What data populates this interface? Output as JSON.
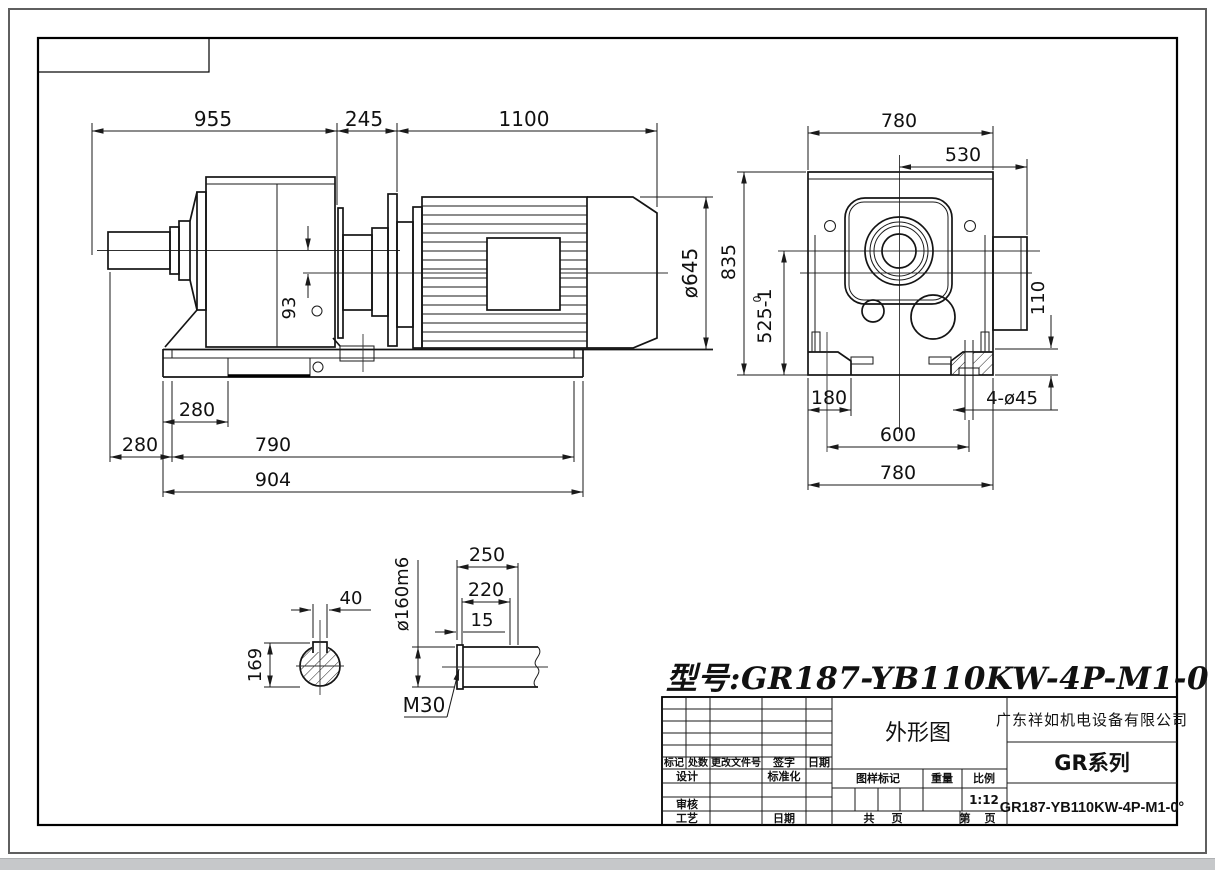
{
  "drawing": {
    "model_title": "型号:GR187-YB110KW-4P-M1-0"
  },
  "side": {
    "d955": "955",
    "d245": "245",
    "d1100": "1100",
    "d645": "ø645",
    "d93": "93",
    "d280a": "280",
    "d280b": "280",
    "d790": "790",
    "d904": "904"
  },
  "front": {
    "d780t": "780",
    "d530": "530",
    "d835": "835",
    "d525": "525-1",
    "d525tol": "0",
    "d110": "110",
    "d180": "180",
    "d600": "600",
    "d780b": "780",
    "dholes": "4-ø45"
  },
  "shaft": {
    "d40": "40",
    "d169": "169",
    "d160": "ø160m6",
    "d250": "250",
    "d220": "220",
    "d15": "15",
    "m30": "M30"
  },
  "tb": {
    "drawing_name": "外形图",
    "company": "广东祥如机电设备有限公司",
    "series": "GR系列",
    "model": "GR187-YB110KW-4P-M1-0°",
    "scale_value": "1:12",
    "mark": "标记",
    "count": "处数",
    "change_doc": "更改文件号",
    "sign": "签字",
    "date": "日期",
    "design": "设计",
    "standardize": "标准化",
    "check": "审核",
    "craft": "工艺",
    "date2": "日期",
    "drawing_mark": "图样标记",
    "weight": "重量",
    "ratio": "比例",
    "total": "共",
    "page": "页",
    "no": "第",
    "page2": "页"
  }
}
